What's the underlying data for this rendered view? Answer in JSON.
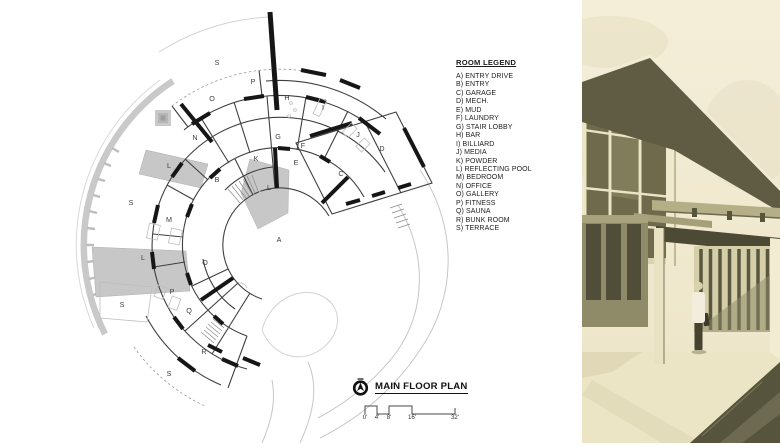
{
  "legend": {
    "title": "ROOM LEGEND",
    "items": [
      "A) ENTRY DRIVE",
      "B) ENTRY",
      "C) GARAGE",
      "D) MECH.",
      "E) MUD",
      "F) LAUNDRY",
      "G) STAIR LOBBY",
      "H) BAR",
      "I) BILLIARD",
      "J) MEDIA",
      "K) POWDER",
      "L) REFLECTING POOL",
      "M) BEDROOM",
      "N) OFFICE",
      "O) GALLERY",
      "P) FITNESS",
      "Q) SAUNA",
      "R) BUNK ROOM",
      "S) TERRACE"
    ]
  },
  "titleblock": {
    "title": "MAIN FLOOR PLAN",
    "north_arrow_icon": "north-arrow",
    "scale_labels": [
      "0'",
      "4'",
      "8'",
      "16'",
      "32'"
    ]
  },
  "plan": {
    "room_labels": [
      {
        "t": "S",
        "x": 217,
        "y": 63
      },
      {
        "t": "P",
        "x": 253,
        "y": 82
      },
      {
        "t": "O",
        "x": 212,
        "y": 99
      },
      {
        "t": "H",
        "x": 287,
        "y": 98
      },
      {
        "t": "I",
        "x": 323,
        "y": 108
      },
      {
        "t": "J",
        "x": 358,
        "y": 135
      },
      {
        "t": "N",
        "x": 195,
        "y": 138
      },
      {
        "t": "G",
        "x": 278,
        "y": 137
      },
      {
        "t": "F",
        "x": 303,
        "y": 146
      },
      {
        "t": "D",
        "x": 382,
        "y": 149
      },
      {
        "t": "K",
        "x": 256,
        "y": 159
      },
      {
        "t": "E",
        "x": 296,
        "y": 163
      },
      {
        "t": "L",
        "x": 169,
        "y": 166
      },
      {
        "t": "C",
        "x": 341,
        "y": 174
      },
      {
        "t": "B",
        "x": 217,
        "y": 180
      },
      {
        "t": "L",
        "x": 269,
        "y": 188
      },
      {
        "t": "S",
        "x": 131,
        "y": 203
      },
      {
        "t": "M",
        "x": 169,
        "y": 220
      },
      {
        "t": "A",
        "x": 279,
        "y": 240
      },
      {
        "t": "L",
        "x": 143,
        "y": 258
      },
      {
        "t": "O",
        "x": 205,
        "y": 263
      },
      {
        "t": "P",
        "x": 172,
        "y": 292
      },
      {
        "t": "S",
        "x": 122,
        "y": 305
      },
      {
        "t": "Q",
        "x": 189,
        "y": 311
      },
      {
        "t": "R",
        "x": 204,
        "y": 352
      },
      {
        "t": "S",
        "x": 169,
        "y": 374
      }
    ],
    "colors": {
      "wall": "#3f3f3f",
      "heavy_wall": "#161616",
      "pool_fill": "#c7c7c7",
      "site_band": "#c9c9c9",
      "topo_line": "#c6c6c6"
    }
  },
  "rendering": {
    "palette": {
      "sky": "#f3edd6",
      "roof": "#5f5c43",
      "glass": "#6e6a4b",
      "mullion": "#ece6c8",
      "beam": "#b5af88",
      "slat": "#5a5740",
      "ground": "#ebe4c5",
      "shadow": "#57543e",
      "figure_coat": "#f2eddc"
    }
  }
}
